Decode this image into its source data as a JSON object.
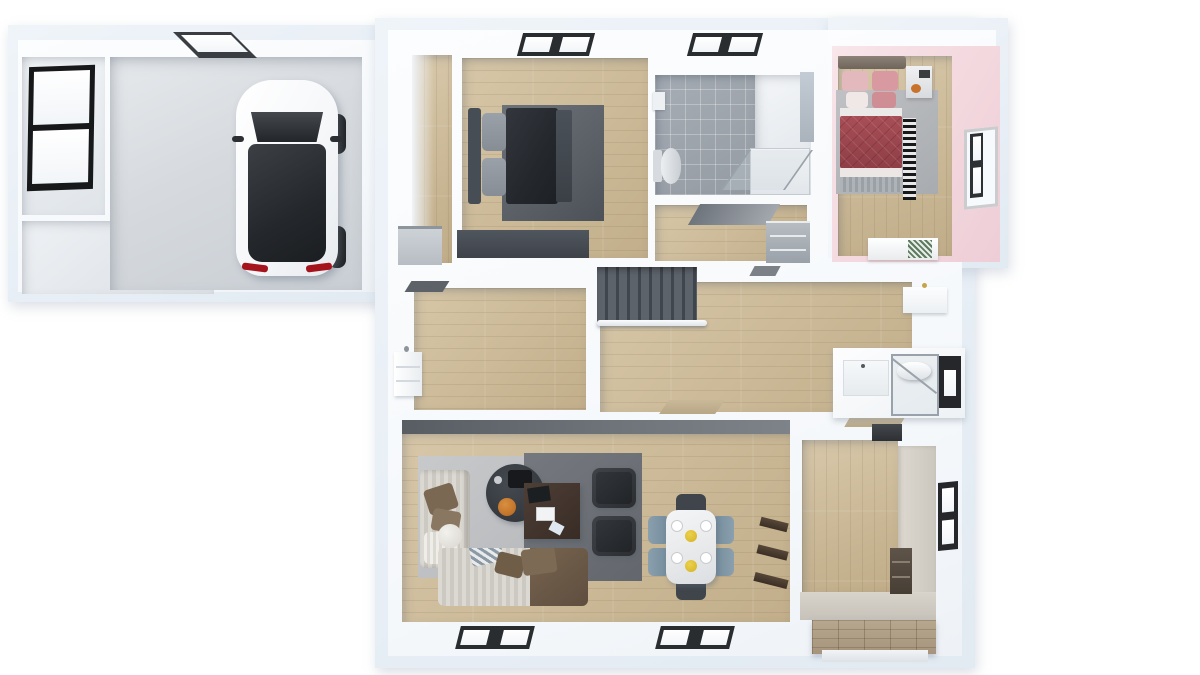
{
  "scene": {
    "title": "3D top-down floor plan rendering of a single-storey house with attached garage",
    "render_style": "white cutaway walls, photoreal furniture, bird's-eye view",
    "background": "#ffffff",
    "palette": {
      "outer_wall_tint": "#e9eff6",
      "wall_white": "#fafcfd",
      "wood_floor": "#ccba98",
      "concrete_floor": "#d4d8dc",
      "bathroom_tile": "#9aa1a9",
      "pink_wall": "#f3d9df",
      "stair_carpet": "#555b63",
      "dark_bedding": "#26292e",
      "red_quilt": "#a04a52",
      "blue_chairs": "#7e96a5",
      "yellow_plates": "#e2c235",
      "orange_bowl": "#c1762a",
      "sofa_brown": "#6b5949",
      "desk_wood": "#463831"
    },
    "areas": {
      "garage_wing": {
        "label": "Garage wing (top left)",
        "rooms": [
          {
            "name": "storage room",
            "floor": "white",
            "features": [
              "black framed window on left wall"
            ]
          },
          {
            "name": "side room",
            "floor": "light gray",
            "features": []
          },
          {
            "name": "garage",
            "floor": "concrete",
            "features": [
              "white hatchback car seen from above",
              "roof opening / skylight at top wall"
            ]
          }
        ]
      },
      "main_house": {
        "label": "Main house",
        "rooms": [
          {
            "name": "entry closet",
            "floor": "wood",
            "features": [
              "narrow corridor",
              "gray niche"
            ]
          },
          {
            "name": "gray bedroom",
            "floor": "wood",
            "features": [
              "window on top wall",
              "double bed with dark duvet and gray pillows",
              "dark gray rug",
              "dark dresser on bottom wall"
            ]
          },
          {
            "name": "bathroom",
            "floor": "gray tile",
            "features": [
              "window on top wall",
              "toilet",
              "glass walk-in shower",
              "wall mirror"
            ]
          },
          {
            "name": "inner hall",
            "floor": "wood",
            "features": [
              "open door panel",
              "gray cabinet"
            ]
          },
          {
            "name": "pink bedroom",
            "floor": "wood",
            "features": [
              "pink walls",
              "bed with red quilt and pink-white pillows",
              "gray rug",
              "black-white striped runner",
              "nightstand with decor",
              "white bench with green checkered cushion",
              "window on right wall"
            ]
          },
          {
            "name": "sitting room",
            "floor": "wood",
            "features": [
              "white wall cabinet with faucet",
              "dark threshold at top door"
            ]
          },
          {
            "name": "hallway",
            "floor": "wood",
            "features": [
              "dark gray carpeted staircase",
              "white handrail",
              "tan doormats",
              "white wall cabinet"
            ]
          },
          {
            "name": "wc",
            "floor": "white",
            "features": [
              "toilet behind glass door",
              "window on right wall"
            ]
          },
          {
            "name": "living room",
            "floor": "wood",
            "features": [
              "striped beige corner sofa",
              "brown sofa",
              "brown cushions",
              "white throw",
              "round dark coffee table with orange bowl",
              "dark wood desk",
              "two black armchairs",
              "light and dark gray rugs",
              "two windows on bottom wall"
            ]
          },
          {
            "name": "dining area",
            "floor": "wood",
            "features": [
              "white marble table",
              "four blue-gray chairs",
              "two dark head chairs",
              "yellow and white place settings",
              "dark wood wall shelves"
            ]
          },
          {
            "name": "kitchen utility room",
            "floor": "wood",
            "features": [
              "L-shaped beige counter",
              "dark wood drawer unit",
              "dark appliance at top wall",
              "window on right wall"
            ]
          },
          {
            "name": "exterior",
            "floor": "-",
            "features": [
              "wooden deck steps outside bottom-right"
            ]
          }
        ]
      }
    }
  }
}
